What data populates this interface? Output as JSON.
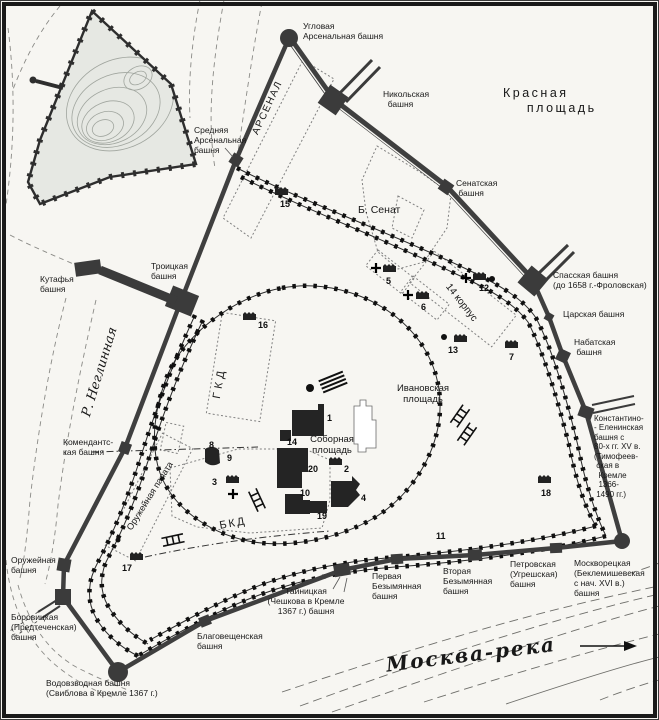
{
  "map": {
    "name": "План Московского Кремля",
    "colors": {
      "paper": "#f7f6f2",
      "wall": "#3f3f3f",
      "old_wall_teeth": "#111111",
      "water_line": "#777777",
      "hill_fill": "#e6e8e3",
      "dotted_building": "#808080",
      "frame": "#1a1a1a"
    },
    "icons": {
      "numbered_building_icon": "small dark building block with serrated roof",
      "river_flow_arrow_icon": "→",
      "church_cross_icon": "+",
      "stairs_icon": "ladder hatch",
      "corner_tower_icon": "filled circle",
      "gate_tower_icon": "large filled square"
    },
    "labels": [
      {
        "id": "uglovaya-arsenalnaya-tower",
        "text": "Угловая\nАрсенальная башня",
        "x": 303,
        "y": 21,
        "fs": 8.5
      },
      {
        "id": "srednyaya-arsenalnaya-tower",
        "text": "Средняя\nАрсенальная\nбашня",
        "x": 194,
        "y": 125,
        "fs": 8.5
      },
      {
        "id": "arsenal-building",
        "text": "АРСЕНАЛ",
        "x": 268,
        "y": 108,
        "fs": 10,
        "rot": -65,
        "align": "center",
        "ls": 1.5
      },
      {
        "id": "nikolskaya-tower",
        "text": "Никольская\n  башня",
        "x": 383,
        "y": 89,
        "fs": 8.5
      },
      {
        "id": "krasnaya-ploshchad",
        "text": "Красная\n    площадь",
        "x": 503,
        "y": 86,
        "fs": 12.5,
        "ls": 2.5
      },
      {
        "id": "senatskaya-tower",
        "text": "Сенатская\n башня",
        "x": 456,
        "y": 178,
        "fs": 8.5
      },
      {
        "id": "bolshoy-senat",
        "text": "Б. Сенат",
        "x": 358,
        "y": 204,
        "fs": 10.5
      },
      {
        "id": "spasskaya-tower",
        "text": "Спасская башня\n(до 1658 г.-Фроловская)",
        "x": 553,
        "y": 270,
        "fs": 8.5
      },
      {
        "id": "tsarskaya-tower",
        "text": "Царская башня",
        "x": 563,
        "y": 309,
        "fs": 8.5
      },
      {
        "id": "nabatnaya-tower",
        "text": "Набатская\n башня",
        "x": 574,
        "y": 337,
        "fs": 8.5
      },
      {
        "id": "konstantino-eleninskaya-tower",
        "text": "Константино-\n- Еленинская\nбашня с\n80-х гг. XV в.\n(Тимофеев-\n ская в\n  Кремле\n  1366-\n 1490 гг.)",
        "x": 594,
        "y": 414,
        "fs": 8
      },
      {
        "id": "moskvoretskaya-tower",
        "text": "Москворецкая\n(Беклемишевская\nс нач. XVI в.)\nбашня",
        "x": 574,
        "y": 558,
        "fs": 8.5
      },
      {
        "id": "petrovskaya-tower",
        "text": "Петровская\n(Угрешская)\nбашня",
        "x": 510,
        "y": 559,
        "fs": 8.5
      },
      {
        "id": "vtoraya-bezymyannaya-tower",
        "text": "Вторая\nБезымянная\nбашня",
        "x": 443,
        "y": 566,
        "fs": 8.5
      },
      {
        "id": "pervaya-bezymyannaya-tower",
        "text": "Первая\nБезымянная\nбашня",
        "x": 372,
        "y": 571,
        "fs": 8.5
      },
      {
        "id": "tainitskaya-tower",
        "text": "Тайницкая\n(Чешкова в Кремле\n1367 г.) башня",
        "x": 306,
        "y": 601,
        "fs": 8.5,
        "align": "center"
      },
      {
        "id": "blagoveshchenskaya-tower",
        "text": "Благовещенская\nбашня",
        "x": 197,
        "y": 631,
        "fs": 8.5
      },
      {
        "id": "vodovzvodnaya-tower",
        "text": "Водовзводная башня\n(Свиблова в Кремле 1367 г.)",
        "x": 46,
        "y": 678,
        "fs": 8.5
      },
      {
        "id": "borovitskaya-tower",
        "text": "Боровицкая\n(Предтеченская)\nбашня",
        "x": 11,
        "y": 612,
        "fs": 8.5
      },
      {
        "id": "oruzheinaya-tower",
        "text": "Оружейная\nбашня",
        "x": 11,
        "y": 555,
        "fs": 8.5
      },
      {
        "id": "komendantskaya-tower",
        "text": "Комендантс-\nкая башня",
        "x": 63,
        "y": 437,
        "fs": 8.5
      },
      {
        "id": "kutafya-tower",
        "text": "Кутафья\nбашня",
        "x": 40,
        "y": 274,
        "fs": 8.5
      },
      {
        "id": "troitskaya-tower",
        "text": "Троицкая\nбашня",
        "x": 151,
        "y": 261,
        "fs": 8.5
      },
      {
        "id": "reka-neglinnaya",
        "text": "Р. Неглинная",
        "x": 100,
        "y": 372,
        "fs": 13,
        "rot": -73,
        "align": "center",
        "serif": true,
        "italic": true
      },
      {
        "id": "gkd-building",
        "text": "ГКД",
        "x": 220,
        "y": 383,
        "fs": 11,
        "rot": -80,
        "align": "center",
        "ls": 4
      },
      {
        "id": "bkd-building",
        "text": "БКД",
        "x": 233,
        "y": 524,
        "fs": 11,
        "rot": -10,
        "align": "center",
        "ls": 2
      },
      {
        "id": "oruzheinaya-palata",
        "text": "Оружейная палата",
        "x": 150,
        "y": 496,
        "fs": 9,
        "rot": -58,
        "align": "center"
      },
      {
        "id": "sobornaya-ploshchad",
        "text": "Соборная\nплощадь",
        "x": 332,
        "y": 445,
        "fs": 9.5,
        "align": "center"
      },
      {
        "id": "ivanovskaya-ploshchad",
        "text": "Ивановская\nплощадь",
        "x": 423,
        "y": 394,
        "fs": 9.5,
        "align": "center"
      },
      {
        "id": "korpus-14",
        "text": "14 корпус",
        "x": 461,
        "y": 303,
        "fs": 10,
        "rot": 52,
        "align": "center"
      },
      {
        "id": "moskva-reka",
        "text": "Москва-река",
        "x": 471,
        "y": 655,
        "fs": 20,
        "rot": -7,
        "align": "center",
        "serif": true,
        "italic": true,
        "bold": true,
        "ls": 2
      }
    ],
    "markers": [
      {
        "n": "1",
        "x": 327,
        "y": 421,
        "icon": false
      },
      {
        "n": "2",
        "x": 344,
        "y": 472,
        "icon": true,
        "ix": 329,
        "iy": 456
      },
      {
        "n": "3",
        "x": 212,
        "y": 485,
        "icon": true,
        "ix": 226,
        "iy": 474
      },
      {
        "n": "4",
        "x": 361,
        "y": 501,
        "icon": false
      },
      {
        "n": "5",
        "x": 386,
        "y": 284,
        "icon": true,
        "ix": 383,
        "iy": 263
      },
      {
        "n": "6",
        "x": 421,
        "y": 310,
        "icon": true,
        "ix": 416,
        "iy": 290
      },
      {
        "n": "7",
        "x": 509,
        "y": 360,
        "icon": true,
        "ix": 505,
        "iy": 339
      },
      {
        "n": "8",
        "x": 209,
        "y": 448,
        "icon": false
      },
      {
        "n": "9",
        "x": 227,
        "y": 461,
        "icon": false
      },
      {
        "n": "10",
        "x": 300,
        "y": 496,
        "icon": false
      },
      {
        "n": "11",
        "x": 436,
        "y": 539,
        "icon": false
      },
      {
        "n": "12",
        "x": 479,
        "y": 291,
        "icon": true,
        "ix": 473,
        "iy": 271
      },
      {
        "n": "13",
        "x": 448,
        "y": 353,
        "icon": true,
        "ix": 454,
        "iy": 333
      },
      {
        "n": "14",
        "x": 287,
        "y": 445,
        "icon": false
      },
      {
        "n": "15",
        "x": 280,
        "y": 207,
        "icon": true,
        "ix": 275,
        "iy": 186
      },
      {
        "n": "16",
        "x": 258,
        "y": 328,
        "icon": true,
        "ix": 243,
        "iy": 311
      },
      {
        "n": "17",
        "x": 122,
        "y": 571,
        "icon": true,
        "ix": 130,
        "iy": 551
      },
      {
        "n": "18",
        "x": 541,
        "y": 496,
        "icon": true,
        "ix": 538,
        "iy": 474
      },
      {
        "n": "19",
        "x": 317,
        "y": 519,
        "icon": false
      },
      {
        "n": "20",
        "x": 308,
        "y": 472,
        "icon": false
      }
    ]
  }
}
